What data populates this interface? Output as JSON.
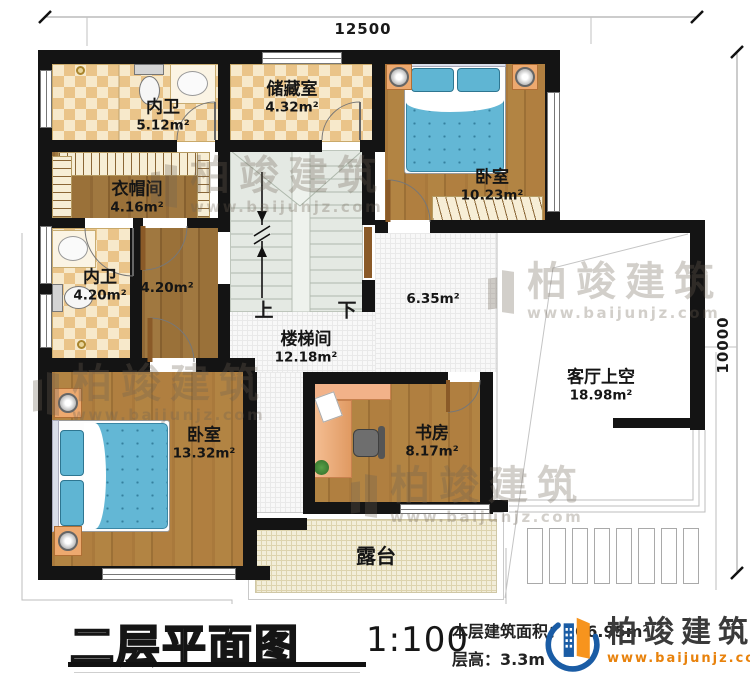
{
  "dimensions": {
    "top": "12500",
    "right": "10000"
  },
  "rooms": {
    "bath1": {
      "name": "内卫",
      "area": "5.12m²"
    },
    "storage": {
      "name": "储藏室",
      "area": "4.32m²"
    },
    "bedroom1": {
      "name": "卧室",
      "area": "10.23m²"
    },
    "cloak": {
      "name": "衣帽间",
      "area": "4.16m²"
    },
    "bath2": {
      "name": "内卫",
      "area": "4.20m²"
    },
    "corridor": {
      "area": "4.20m²"
    },
    "stair": {
      "name": "楼梯间",
      "area": "12.18m²",
      "up": "上",
      "down": "下"
    },
    "hall": {
      "area": "6.35m²"
    },
    "bedroom2": {
      "name": "卧室",
      "area": "13.32m²"
    },
    "study": {
      "name": "书房",
      "area": "8.17m²"
    },
    "livingvoid": {
      "name": "客厅上空",
      "area": "18.98m²"
    },
    "terrace": {
      "name": "露台"
    }
  },
  "footer": {
    "title": "二层平面图",
    "scale": "1:100",
    "area_label": "本层建筑面积：",
    "area_value": "106.95m²",
    "height_label": "层高：",
    "height_value": "3.3m"
  },
  "brand": {
    "name": "柏竣建筑",
    "url": "www.baijunjz.com"
  },
  "watermark": {
    "name": "柏竣建筑",
    "url": "www.baijunjz.com"
  },
  "colors": {
    "wall": "#141414",
    "accent_blue": "#1a5ca5",
    "accent_orange": "#f7941d",
    "bed_blue": "#63b7d5",
    "wood": "#ac7b3d",
    "checker_tile": "#eac489"
  }
}
